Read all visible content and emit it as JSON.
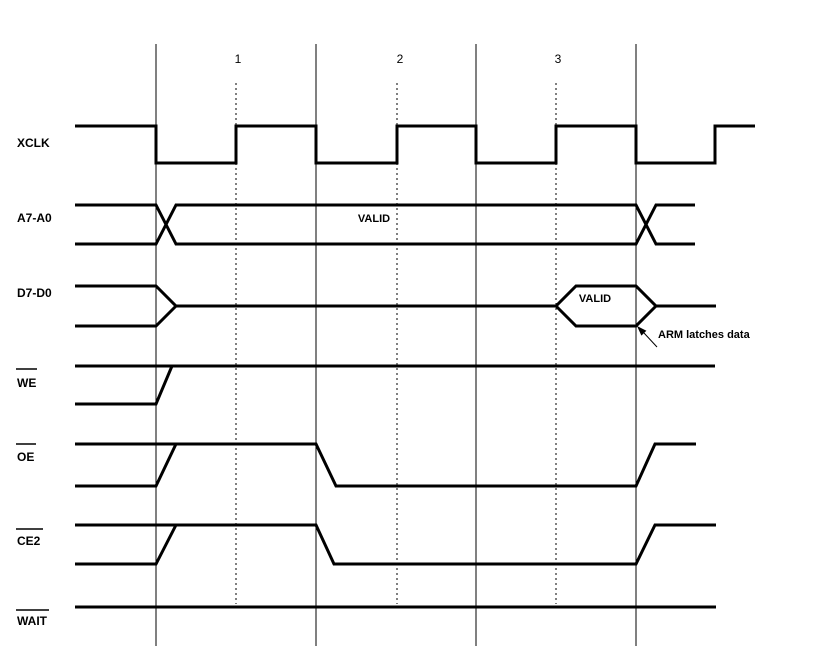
{
  "palette": {
    "background": "#ffffff",
    "ink": "#000000"
  },
  "diagram_type": "timing-waveform",
  "grid": {
    "solid_vlines": {
      "xs": [
        156,
        316,
        476,
        636
      ],
      "y1": 44,
      "y2": 646
    },
    "dotted_vlines": {
      "xs": [
        236,
        397,
        556
      ],
      "y1": 83,
      "y2": 604
    },
    "cycle_numbers": [
      {
        "label": "1",
        "x": 238,
        "y": 63
      },
      {
        "label": "2",
        "x": 400,
        "y": 63
      },
      {
        "label": "3",
        "x": 558,
        "y": 63
      }
    ]
  },
  "signals": [
    {
      "id": "xclk",
      "name": "XCLK",
      "overline": false,
      "label": {
        "x": 17,
        "y": 147
      },
      "polylines": [
        [
          [
            75,
            126
          ],
          [
            156,
            126
          ],
          [
            156,
            163
          ],
          [
            236,
            163
          ],
          [
            236,
            126
          ],
          [
            316,
            126
          ],
          [
            316,
            163
          ],
          [
            397,
            163
          ],
          [
            397,
            126
          ],
          [
            476,
            126
          ],
          [
            476,
            163
          ],
          [
            556,
            163
          ],
          [
            556,
            126
          ],
          [
            636,
            126
          ],
          [
            636,
            163
          ],
          [
            715,
            163
          ],
          [
            715,
            126
          ],
          [
            755,
            126
          ]
        ]
      ]
    },
    {
      "id": "addr",
      "name": "A7-A0",
      "overline": false,
      "label": {
        "x": 17,
        "y": 222
      },
      "polylines": [
        [
          [
            75,
            205
          ],
          [
            156,
            205
          ],
          [
            176,
            244
          ],
          [
            636,
            244
          ],
          [
            656,
            205
          ],
          [
            695,
            205
          ]
        ],
        [
          [
            75,
            244
          ],
          [
            156,
            244
          ],
          [
            176,
            205
          ],
          [
            636,
            205
          ],
          [
            656,
            244
          ],
          [
            695,
            244
          ]
        ]
      ]
    },
    {
      "id": "data",
      "name": "D7-D0",
      "overline": false,
      "label": {
        "x": 17,
        "y": 297
      },
      "polylines": [
        [
          [
            75,
            286
          ],
          [
            156,
            286
          ],
          [
            176,
            306
          ],
          [
            556,
            306
          ],
          [
            576,
            286
          ],
          [
            636,
            286
          ],
          [
            656,
            306
          ],
          [
            716,
            306
          ]
        ],
        [
          [
            75,
            326
          ],
          [
            156,
            326
          ],
          [
            176,
            306
          ]
        ],
        [
          [
            556,
            306
          ],
          [
            576,
            326
          ],
          [
            636,
            326
          ],
          [
            656,
            306
          ]
        ]
      ]
    },
    {
      "id": "we",
      "name": "WE",
      "overline": true,
      "label": {
        "x": 17,
        "y": 387
      },
      "overline_geom": {
        "x1": 16,
        "x2": 37,
        "y": 369
      },
      "polylines": [
        [
          [
            75,
            366
          ],
          [
            715,
            366
          ]
        ],
        [
          [
            75,
            404
          ],
          [
            156,
            404
          ],
          [
            172,
            366
          ]
        ]
      ]
    },
    {
      "id": "oe",
      "name": "OE",
      "overline": true,
      "label": {
        "x": 17,
        "y": 461
      },
      "overline_geom": {
        "x1": 16,
        "x2": 36,
        "y": 444
      },
      "polylines": [
        [
          [
            75,
            444
          ],
          [
            316,
            444
          ],
          [
            336,
            486
          ],
          [
            636,
            486
          ],
          [
            655,
            444
          ],
          [
            696,
            444
          ]
        ],
        [
          [
            75,
            486
          ],
          [
            156,
            486
          ],
          [
            176,
            444
          ]
        ]
      ]
    },
    {
      "id": "ce2",
      "name": "CE2",
      "overline": true,
      "label": {
        "x": 17,
        "y": 545
      },
      "overline_geom": {
        "x1": 16,
        "x2": 43,
        "y": 529
      },
      "polylines": [
        [
          [
            75,
            525
          ],
          [
            316,
            525
          ],
          [
            334,
            564
          ],
          [
            636,
            564
          ],
          [
            655,
            525
          ],
          [
            716,
            525
          ]
        ],
        [
          [
            75,
            564
          ],
          [
            156,
            564
          ],
          [
            176,
            525
          ]
        ]
      ]
    },
    {
      "id": "wait",
      "name": "WAIT",
      "overline": true,
      "label": {
        "x": 17,
        "y": 625
      },
      "overline_geom": {
        "x1": 16,
        "x2": 49,
        "y": 610
      },
      "polylines": [
        [
          [
            75,
            607
          ],
          [
            716,
            607
          ]
        ]
      ]
    }
  ],
  "annotations": [
    {
      "id": "addr-valid",
      "text": "VALID",
      "x": 374,
      "y": 222,
      "anchor": "middle"
    },
    {
      "id": "data-valid",
      "text": "VALID",
      "x": 595,
      "y": 302,
      "anchor": "middle"
    },
    {
      "id": "arm-latches-data",
      "text": "ARM latches data",
      "x": 658,
      "y": 338,
      "anchor": "start"
    }
  ],
  "arrow": {
    "line": {
      "x1": 657,
      "y1": 347,
      "x2": 644,
      "y2": 333
    },
    "head_points": "637,326 646.4,330.8 641.4,335.6"
  }
}
